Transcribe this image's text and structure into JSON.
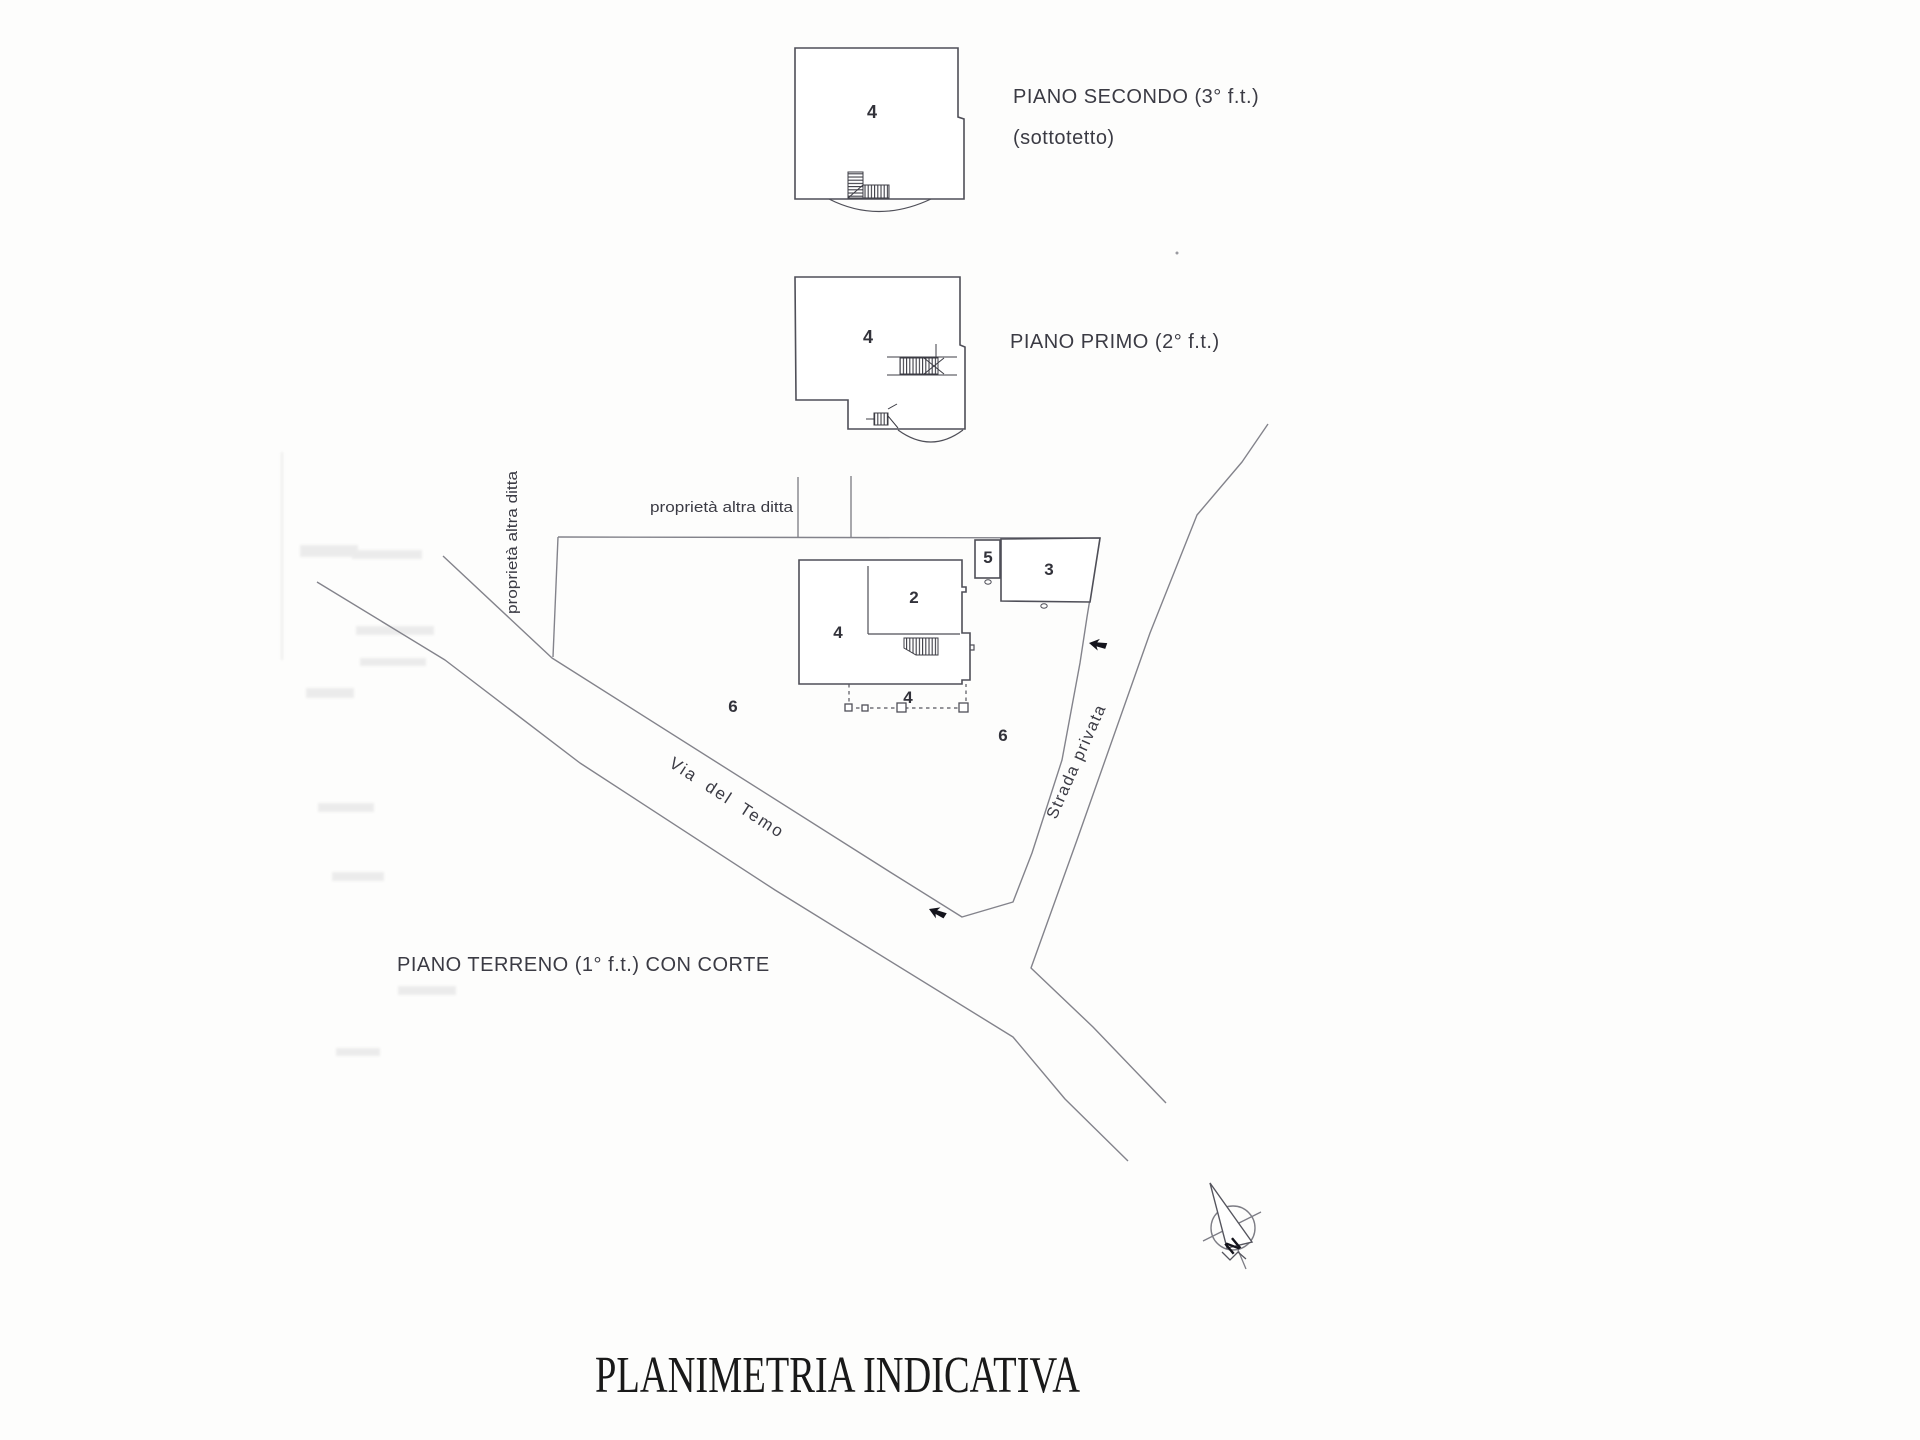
{
  "title": "PLANIMETRIA INDICATIVA",
  "floors": {
    "second": {
      "label": "PIANO SECONDO (3° f.t.)",
      "sublabel": "(sottotetto)",
      "unit": "4"
    },
    "first": {
      "label": "PIANO PRIMO (2° f.t.)",
      "unit": "4"
    },
    "ground": {
      "label": "PIANO TERRENO (1° f.t.) CON CORTE"
    }
  },
  "site": {
    "boundary_label_vertical": "proprietà altra ditta",
    "boundary_label_horizontal": "proprietà altra ditta",
    "road_main": "Via del Temo",
    "road_private": "Strada privata",
    "units": {
      "u2": "2",
      "u3": "3",
      "u4_building": "4",
      "u4_canopy": "4",
      "u5": "5",
      "u6_west": "6",
      "u6_east": "6"
    }
  },
  "compass": {
    "north": "N"
  },
  "colors": {
    "plan_line": "#4f4f58",
    "site_line": "#83838b",
    "label_text": "#3b3b44",
    "title_text": "#191919"
  }
}
